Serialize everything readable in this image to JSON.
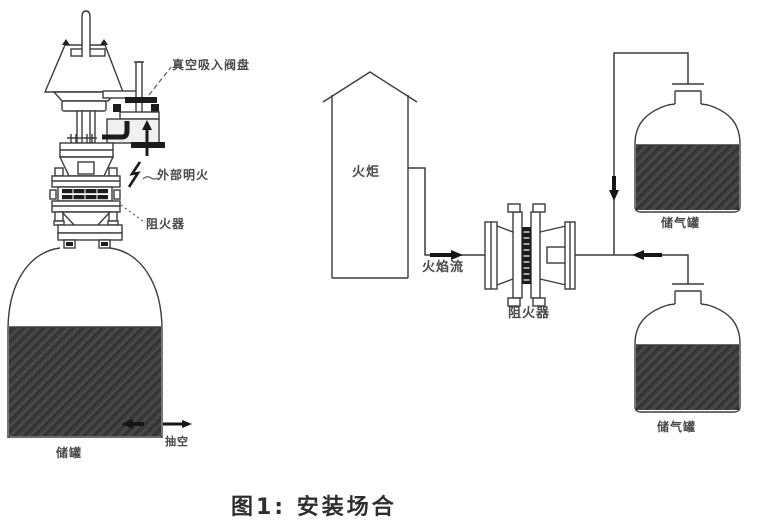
{
  "figure": {
    "caption": "图1: 安装场合"
  },
  "left_diagram": {
    "description_names": [
      "breather-valve",
      "flame-arrester",
      "storage-tank"
    ],
    "labels": {
      "vacuum_valve_disc": "真空吸入阀盘",
      "external_open_flame": "外部明火",
      "flame_arrester": "阻火器",
      "storage_tank": "储罐",
      "pump_out": "抽空"
    }
  },
  "right_diagram": {
    "description_names": [
      "flare-stack",
      "inline-flame-arrester",
      "gas-tanks"
    ],
    "labels": {
      "flare": "火炬",
      "flame_flow": "火焰流",
      "flame_arrester": "阻火器",
      "gas_tank_top": "储气罐",
      "gas_tank_bottom": "储气罐"
    }
  },
  "colors": {
    "line": "#3c3c3c",
    "thick_flow": "#151515",
    "liquid_fill": "#3e3e3e",
    "label_text": "#4a4a4a",
    "caption_text": "#2e2e2e",
    "background": "#ffffff"
  }
}
